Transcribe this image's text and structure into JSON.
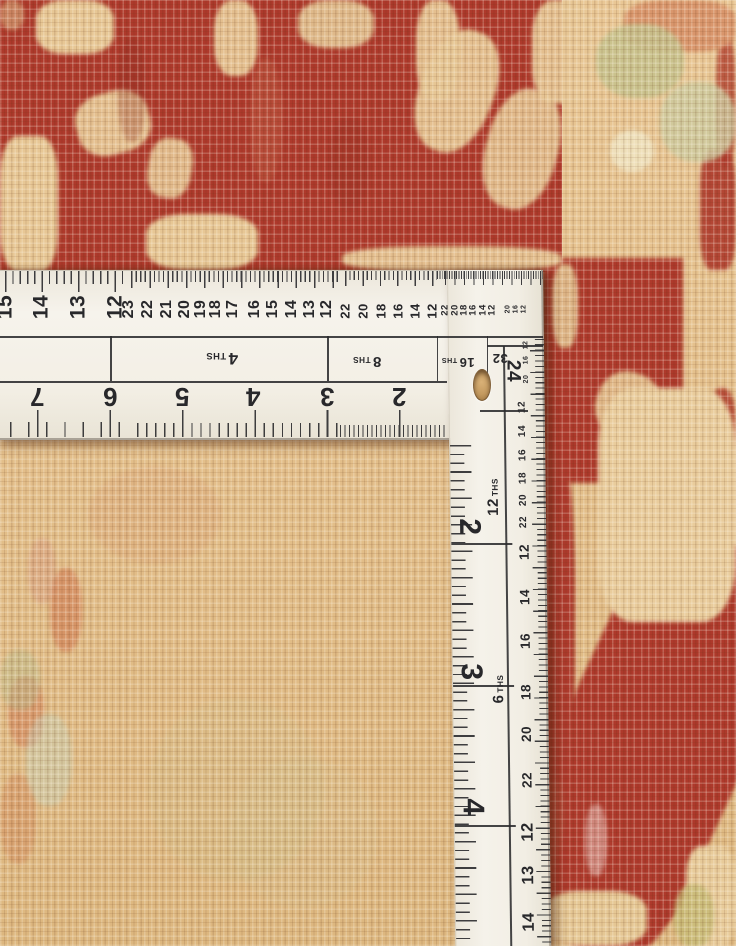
{
  "colors": {
    "rug_red": "#ae392b",
    "rug_beige": "#e7c795",
    "ruler_white": "#f3efe5",
    "marking": "#2b2b2e"
  },
  "ruler": {
    "h_top_scales": [
      {
        "y": 307,
        "size": 21,
        "numbers": [
          {
            "t": "15",
            "x": 5
          },
          {
            "t": "14",
            "x": 41
          },
          {
            "t": "13",
            "x": 78
          },
          {
            "t": "12",
            "x": 115
          }
        ]
      },
      {
        "y": 309,
        "size": 16,
        "numbers": [
          {
            "t": "23",
            "x": 129
          },
          {
            "t": "22",
            "x": 148
          },
          {
            "t": "21",
            "x": 167
          },
          {
            "t": "20",
            "x": 185
          },
          {
            "t": "19",
            "x": 201
          },
          {
            "t": "18",
            "x": 216
          },
          {
            "t": "17",
            "x": 233
          },
          {
            "t": "16",
            "x": 255
          },
          {
            "t": "15",
            "x": 273
          },
          {
            "t": "14",
            "x": 292
          },
          {
            "t": "13",
            "x": 310
          },
          {
            "t": "12",
            "x": 327
          }
        ]
      },
      {
        "y": 311,
        "size": 13,
        "numbers": [
          {
            "t": "22",
            "x": 345
          },
          {
            "t": "20",
            "x": 363
          },
          {
            "t": "18",
            "x": 381
          },
          {
            "t": "16",
            "x": 398
          },
          {
            "t": "14",
            "x": 415
          },
          {
            "t": "12",
            "x": 432
          }
        ]
      },
      {
        "y": 310,
        "size": 9.5,
        "numbers": [
          {
            "t": "22",
            "x": 445
          },
          {
            "t": "20",
            "x": 455
          },
          {
            "t": "18",
            "x": 464
          },
          {
            "t": "16",
            "x": 473
          },
          {
            "t": "14",
            "x": 483
          },
          {
            "t": "12",
            "x": 492
          }
        ]
      },
      {
        "y": 309,
        "size": 7,
        "numbers": [
          {
            "t": "20",
            "x": 508
          },
          {
            "t": "16",
            "x": 516
          },
          {
            "t": "12",
            "x": 524
          }
        ]
      }
    ],
    "h_inch_numbers": {
      "y": 397,
      "size": 26,
      "numbers": [
        {
          "t": "7",
          "x": 37
        },
        {
          "t": "6",
          "x": 110
        },
        {
          "t": "5",
          "x": 182
        },
        {
          "t": "4",
          "x": 253
        },
        {
          "t": "3",
          "x": 327
        },
        {
          "t": "2",
          "x": 399
        }
      ]
    },
    "h_band_labels": [
      {
        "num": "4",
        "suffix": "THS",
        "x": 222,
        "y": 358,
        "size": 17,
        "rot": 180
      },
      {
        "num": "8",
        "suffix": "THS",
        "x": 367,
        "y": 361,
        "size": 15,
        "rot": 180
      },
      {
        "num": "16",
        "suffix": "THS",
        "x": 458,
        "y": 362,
        "size": 13,
        "rot": 180
      },
      {
        "num": "32",
        "suffix": "",
        "x": 500,
        "y": 358,
        "size": 13,
        "rot": 180
      }
    ],
    "corner_label": {
      "t": "24",
      "x": 513,
      "y": 371,
      "size": 19,
      "rot": 90
    },
    "v_band_labels": [
      {
        "num": "12",
        "suffix": "THS",
        "x": 491,
        "y": 497,
        "size": 15,
        "rot": -90
      },
      {
        "num": "6",
        "suffix": "THS",
        "x": 494,
        "y": 689,
        "size": 15,
        "rot": -90
      }
    ],
    "v_big_numbers": {
      "x": 466,
      "size": 30,
      "numbers": [
        {
          "t": "2",
          "y": 527
        },
        {
          "t": "3",
          "y": 672
        },
        {
          "t": "4",
          "y": 807
        }
      ]
    },
    "v_inner_scales": [
      {
        "x": 525,
        "size": 7,
        "numbers": [
          {
            "t": "12",
            "y": 345
          },
          {
            "t": "16",
            "y": 360
          },
          {
            "t": "20",
            "y": 379
          }
        ]
      },
      {
        "x": 521,
        "size": 10,
        "numbers": [
          {
            "t": "12",
            "y": 407
          },
          {
            "t": "14",
            "y": 431
          },
          {
            "t": "16",
            "y": 455
          },
          {
            "t": "18",
            "y": 478
          },
          {
            "t": "20",
            "y": 500
          },
          {
            "t": "22",
            "y": 522
          }
        ]
      },
      {
        "x": 521,
        "size": 13.5,
        "numbers": [
          {
            "t": "12",
            "y": 552
          },
          {
            "t": "14",
            "y": 597
          },
          {
            "t": "16",
            "y": 641
          },
          {
            "t": "18",
            "y": 692
          },
          {
            "t": "20",
            "y": 734
          },
          {
            "t": "22",
            "y": 780
          }
        ]
      },
      {
        "x": 521,
        "size": 16.5,
        "numbers": [
          {
            "t": "12",
            "y": 832
          },
          {
            "t": "13",
            "y": 875
          },
          {
            "t": "14",
            "y": 922
          }
        ]
      }
    ]
  }
}
